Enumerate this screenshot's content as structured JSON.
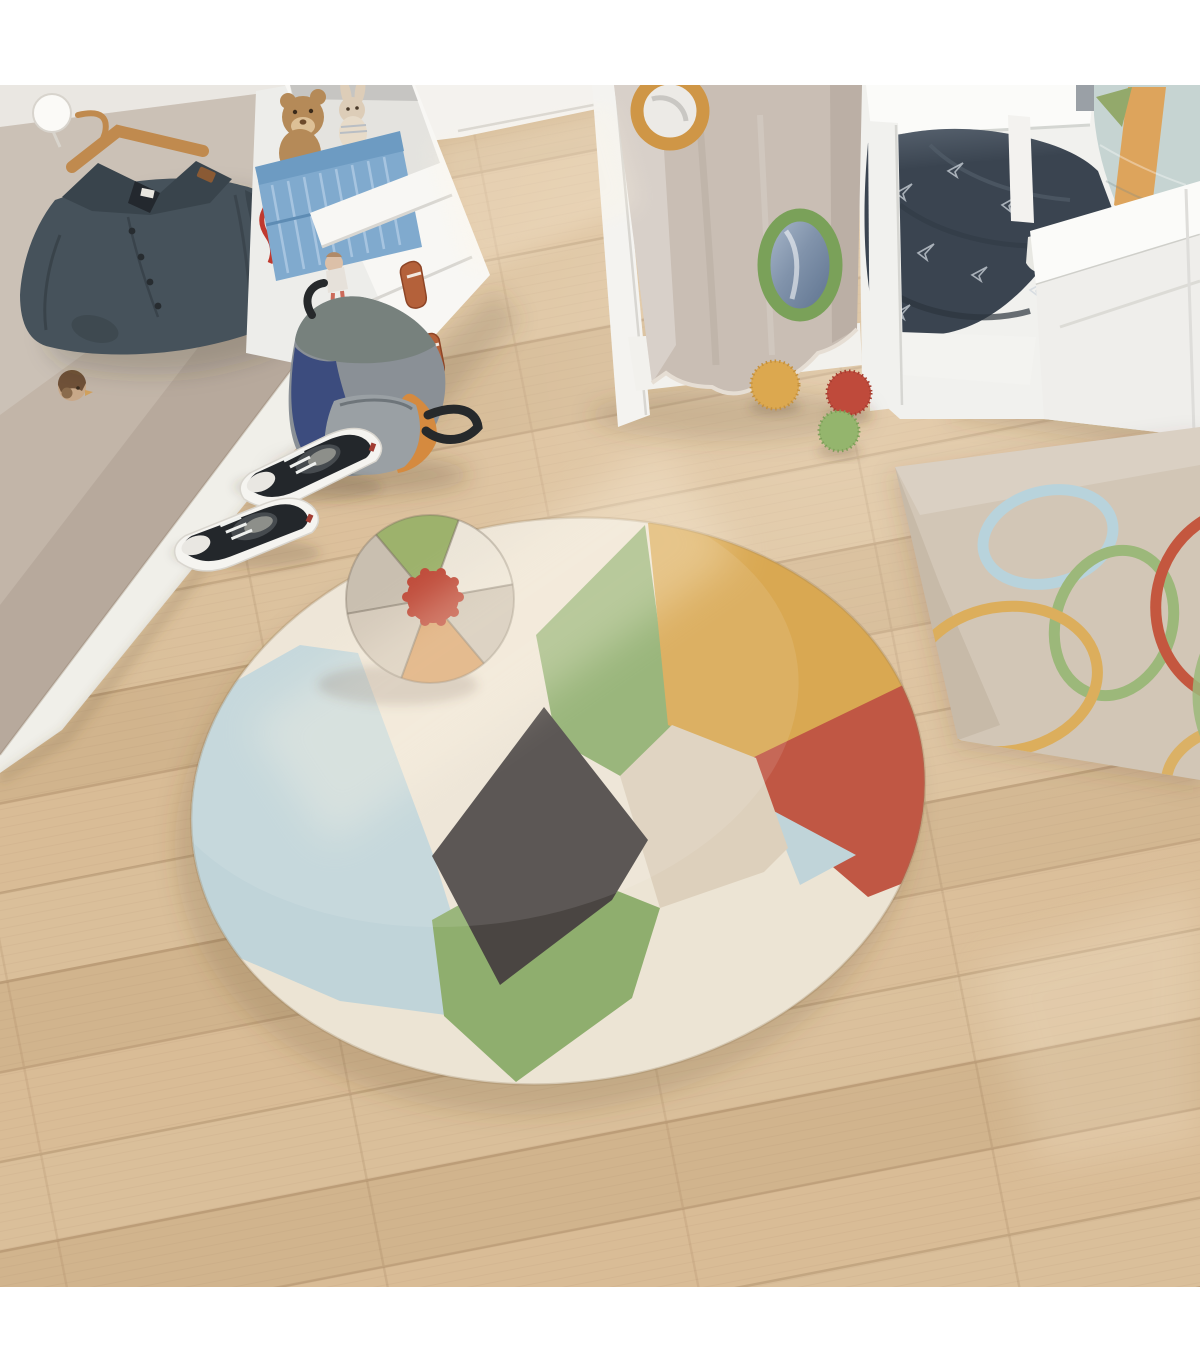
{
  "scene": {
    "type": "photograph",
    "setting": "children's bedroom seen from a high angle",
    "lighting": "warm daylight with diagonal sun streaks on a light oak floor",
    "objects": [
      "wood floor",
      "wardrobe panel",
      "coat hook",
      "wooden hanger",
      "denim jacket",
      "bird knob",
      "white dresser",
      "teddy bear",
      "bunny plush",
      "blue storage crate",
      "hanging doll",
      "leather drawer straps",
      "backpack",
      "black sneakers",
      "bed with beige play canopy",
      "canopy portholes",
      "navy duvet with paper airplanes",
      "blue cushion with orange stripe",
      "three pom-pom balls",
      "beige wall rug with colored loops",
      "round patchwork rug",
      "beach-ball cushion"
    ]
  },
  "palette": {
    "frame_white": "#ffffff",
    "floor": "#d8bb94",
    "wall": "#eae7e2",
    "wall_bright": "#f4f2ee",
    "wardrobe_panel": "#c2b5a8",
    "baseboard": "#f0efe9",
    "jacket": "#46525b",
    "jacket_dark": "#3a454d",
    "hanger_wood": "#c08a4e",
    "hook_white": "#fbfaf7",
    "knob_brown": "#6f5138",
    "knob_tan": "#c8a888",
    "dresser": "#f8f7f4",
    "dresser_side": "#ededea",
    "shelf_interior": "#e4e3df",
    "crate_blue": "#80aace",
    "crate_rim": "#6d9bc2",
    "teddy_brown": "#b58a58",
    "bunny_tan": "#ddcdb8",
    "strap_rust": "#b4613a",
    "backpack_grey": "#8a9096",
    "backpack_flap": "#77817d",
    "backpack_navy": "#3c4c7e",
    "backpack_orange": "#d58a3f",
    "backpack_pocket": "#9aa0a4",
    "shoe_black": "#23272b",
    "shoe_sole": "#f5f4f0",
    "canopy": "#c9beb4",
    "canopy_ring_orange": "#cf9646",
    "canopy_ring_green": "#7aa159",
    "bed_white": "#f1f1ee",
    "headboard": "#fbfbf9",
    "wood_sliver": "#c99f6e",
    "pillow_blue": "#c6d4d2",
    "pillow_stripe": "#dda45c",
    "pillow_green": "#93a96b",
    "duvet_navy": "#3a4450",
    "ball_yellow": "#dca84f",
    "ball_red": "#bf4a3b",
    "ball_green": "#94b56d",
    "wall_rug": "#d2c6b6",
    "loop_blue": "#b8d3dc",
    "loop_green": "#9cb87a",
    "loop_yellow": "#dcae5c",
    "loop_red": "#c4573f",
    "rug_cream": "#ece4d4",
    "rug_blue": "#c0d4d9",
    "rug_yellow": "#d9a852",
    "rug_red": "#c05744",
    "rug_green": "#8fae6e",
    "rug_dark": "#4a4542",
    "rug_tan": "#ddd0bc",
    "balltoy_green": "#9db26c",
    "balltoy_cream": "#ece5d8",
    "balltoy_greige": "#cfc5b6",
    "balltoy_orange": "#d9a26b",
    "balltoy_beige": "#d5cabb",
    "balltoy_taupe": "#c9bfb0",
    "pom_red": "#bf4b3a"
  }
}
